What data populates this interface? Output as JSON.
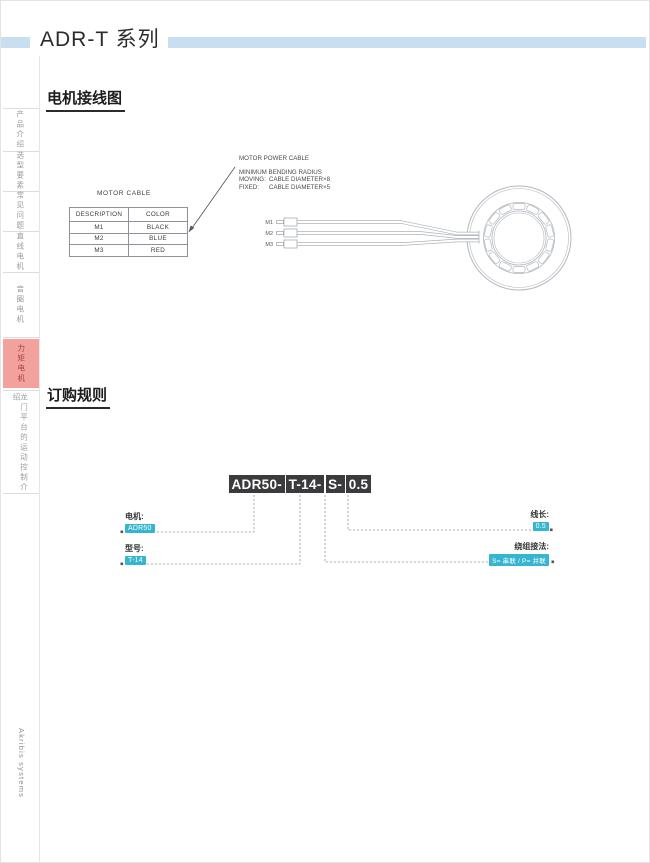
{
  "page": {
    "title": "ADR-T 系列",
    "brand": "Akribis systems"
  },
  "sidebar": {
    "items": [
      {
        "label": "产品介绍",
        "active": false
      },
      {
        "label": "选型要素",
        "active": false
      },
      {
        "label": "常见问题",
        "active": false
      },
      {
        "label": "直线电机",
        "active": false
      },
      {
        "label": "音圈电机",
        "active": false
      },
      {
        "label": "力矩电机",
        "active": true
      },
      {
        "label": "龙门平台的运动控制介绍",
        "active": false
      }
    ]
  },
  "headings": {
    "wiring": "电机接线图",
    "ordering": "订购规则"
  },
  "wiring": {
    "table_title": "MOTOR CABLE",
    "table": {
      "headers": [
        "DESCRIPTION",
        "COLOR"
      ],
      "rows": [
        [
          "M1",
          "BLACK"
        ],
        [
          "M2",
          "BLUE"
        ],
        [
          "M3",
          "RED"
        ]
      ]
    },
    "notes": {
      "power_cable": "MOTOR POWER CABLE",
      "bending_title": "MINIMUM BENDING RADIUS",
      "moving_label": "MOVING:",
      "moving_value": "CABLE DIAMETER×8",
      "fixed_label": "FIXED:",
      "fixed_value": "CABLE DIAMETER×5"
    },
    "cable_labels": [
      "M1",
      "M2",
      "M3"
    ]
  },
  "ordering": {
    "part_number": "ADR50-T-14-S-0.5",
    "segments": [
      "ADR50-",
      "T-14-",
      "S-",
      "0.5"
    ],
    "callouts": [
      {
        "label": "电机:",
        "value": "ADR50"
      },
      {
        "label": "型号:",
        "value": "T-14"
      },
      {
        "label": "线长:",
        "value": "0.5"
      },
      {
        "label": "绕组接法:",
        "value": "S= 串联 / P= 并联"
      }
    ]
  },
  "colors": {
    "header_bar": "#C8DFF2",
    "sidebar_active_bg": "#F2A19D",
    "sidebar_active_text": "#A6403C",
    "highlight_cyan": "#35B5D0",
    "part_number_box": "#3B3B3D"
  }
}
